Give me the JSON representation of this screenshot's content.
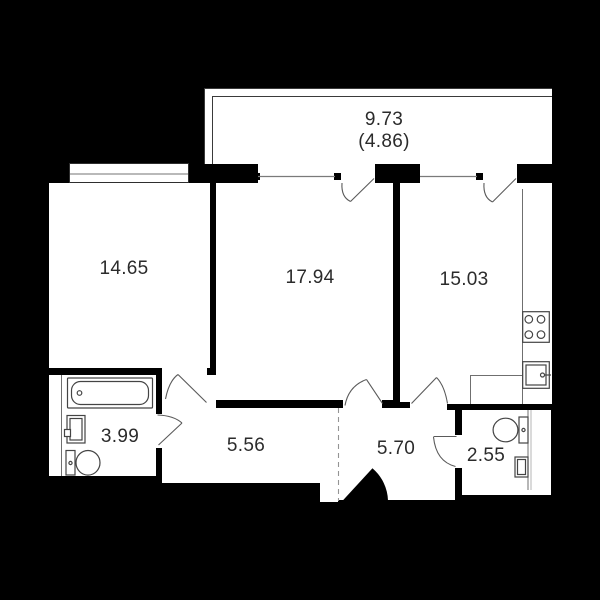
{
  "plan": {
    "type": "apartment-floor-plan",
    "balcony": {
      "area_label": "9.73",
      "reduced_area_label": "(4.86)"
    },
    "rooms": [
      {
        "name": "living-room",
        "area_label": "14.65"
      },
      {
        "name": "bedroom",
        "area_label": "17.94"
      },
      {
        "name": "kitchen",
        "area_label": "15.03"
      },
      {
        "name": "bathroom",
        "area_label": "3.99"
      },
      {
        "name": "hallway",
        "area_label": "5.56"
      },
      {
        "name": "entry-hall",
        "area_label": "5.70"
      },
      {
        "name": "wc",
        "area_label": "2.55"
      }
    ],
    "fixtures": [
      "bathtub",
      "washbasin",
      "toilet",
      "stove",
      "kitchen-sink",
      "wc-toilet",
      "wc-washbasin",
      "entrance-door"
    ],
    "colors": {
      "background": "#000000",
      "floor": "#ffffff",
      "wall": "#000000",
      "thin_line": "#7a7a7a",
      "fixture_line": "#444444",
      "door_line": "#5a5a5a",
      "text": "#2b2b2b"
    }
  }
}
